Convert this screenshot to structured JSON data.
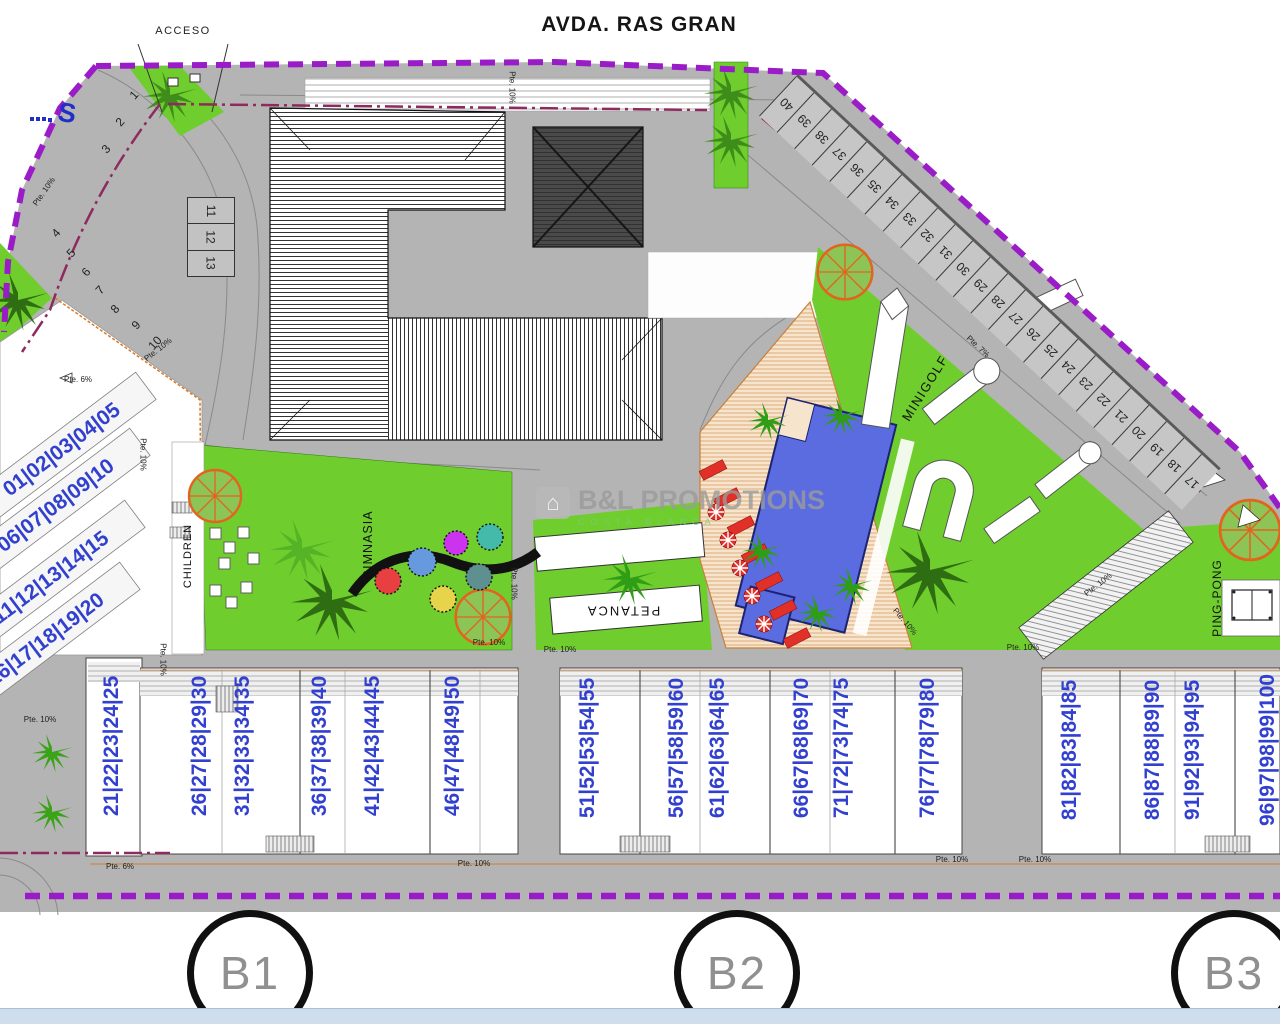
{
  "street_name": "AVDA. RAS GRAN",
  "access_label": "ACCESO",
  "corner_mark": "S",
  "icons": {
    "house": "⌂"
  },
  "watermark": {
    "brand": "B&L PROMOTIONS",
    "tagline": "COSTA BLANCA"
  },
  "zones": {
    "gym": "GIMNASIA",
    "petanca": "PETANCA",
    "minigolf": "MINIGOLF",
    "pingpong": "PING-PONG",
    "children": "CHILDREN"
  },
  "blocks": [
    {
      "id": "B1",
      "x": 250,
      "y": 973
    },
    {
      "id": "B2",
      "x": 737,
      "y": 973
    },
    {
      "id": "B3",
      "x": 1234,
      "y": 973
    }
  ],
  "parking": {
    "right_strip": [
      "40",
      "39",
      "38",
      "37",
      "36",
      "35",
      "34",
      "33",
      "32",
      "31",
      "30",
      "29",
      "28",
      "27",
      "26",
      "25",
      "24",
      "23",
      "22",
      "21",
      "20",
      "19",
      "18",
      "17"
    ],
    "left_upper": [
      {
        "n": "1",
        "x": 134,
        "y": 95,
        "rot": -48
      },
      {
        "n": "2",
        "x": 120,
        "y": 122,
        "rot": -48
      },
      {
        "n": "3",
        "x": 106,
        "y": 149,
        "rot": -48
      }
    ],
    "left_lower": [
      {
        "n": "4",
        "x": 56,
        "y": 233,
        "rot": -48
      },
      {
        "n": "5",
        "x": 71,
        "y": 253,
        "rot": -48
      },
      {
        "n": "6",
        "x": 86,
        "y": 272,
        "rot": -48
      },
      {
        "n": "7",
        "x": 100,
        "y": 290,
        "rot": -48
      },
      {
        "n": "8",
        "x": 115,
        "y": 309,
        "rot": -48
      },
      {
        "n": "9",
        "x": 136,
        "y": 325,
        "rot": -48
      },
      {
        "n": "10",
        "x": 155,
        "y": 343,
        "rot": -48
      }
    ],
    "left_block": [
      "11",
      "12",
      "13"
    ]
  },
  "units": {
    "left_groups": [
      {
        "label": "01|02|03|04|05",
        "x": 62,
        "y": 450,
        "rot": -37
      },
      {
        "label": "06|07|08|09|10",
        "x": 56,
        "y": 506,
        "rot": -37
      },
      {
        "label": "11|12|13|14|15",
        "x": 51,
        "y": 578,
        "rot": -37
      },
      {
        "label": "16|17|18|19|20",
        "x": 46,
        "y": 640,
        "rot": -37
      }
    ],
    "bottom_columns": [
      {
        "label": "21|22|23|24|25",
        "x": 112,
        "y": 746,
        "rot": -90
      },
      {
        "label": "26|27|28|29|30",
        "x": 200,
        "y": 746,
        "rot": -90
      },
      {
        "label": "31|32|33|34|35",
        "x": 243,
        "y": 746,
        "rot": -90
      },
      {
        "label": "36|37|38|39|40",
        "x": 320,
        "y": 746,
        "rot": -90
      },
      {
        "label": "41|42|43|44|45",
        "x": 373,
        "y": 746,
        "rot": -90
      },
      {
        "label": "46|47|48|49|50",
        "x": 453,
        "y": 746,
        "rot": -90
      },
      {
        "label": "51|52|53|54|55",
        "x": 588,
        "y": 748,
        "rot": -90
      },
      {
        "label": "56|57|58|59|60",
        "x": 677,
        "y": 748,
        "rot": -90
      },
      {
        "label": "61|62|63|64|65",
        "x": 718,
        "y": 748,
        "rot": -90
      },
      {
        "label": "66|67|68|69|70",
        "x": 802,
        "y": 748,
        "rot": -90
      },
      {
        "label": "71|72|73|74|75",
        "x": 842,
        "y": 748,
        "rot": -90
      },
      {
        "label": "76|77|78|79|80",
        "x": 928,
        "y": 748,
        "rot": -90
      },
      {
        "label": "81|82|83|84|85",
        "x": 1070,
        "y": 750,
        "rot": -90
      },
      {
        "label": "86|87|88|89|90",
        "x": 1153,
        "y": 750,
        "rot": -90
      },
      {
        "label": "91|92|93|94|95",
        "x": 1193,
        "y": 750,
        "rot": -90
      },
      {
        "label": "96|97|98|99|100",
        "x": 1268,
        "y": 750,
        "rot": -90
      }
    ]
  },
  "slope_labels": [
    {
      "text": "Pte. 10%",
      "x": 512,
      "y": 88,
      "rot": 90
    },
    {
      "text": "Pte. 7%",
      "x": 978,
      "y": 347,
      "rot": 43
    },
    {
      "text": "Pte. 6%",
      "x": 78,
      "y": 380,
      "rot": 0
    },
    {
      "text": "Pte. 10%",
      "x": 158,
      "y": 350,
      "rot": -38
    },
    {
      "text": "Pte. 10%",
      "x": 44,
      "y": 192,
      "rot": -55
    },
    {
      "text": "Pte. 10%",
      "x": 143,
      "y": 455,
      "rot": 90
    },
    {
      "text": "Pte. 10%",
      "x": 905,
      "y": 622,
      "rot": 50
    },
    {
      "text": "Pte. 10%",
      "x": 514,
      "y": 584,
      "rot": 90
    },
    {
      "text": "Pte. 10%",
      "x": 560,
      "y": 650,
      "rot": 0
    },
    {
      "text": "Pte. 10%",
      "x": 489,
      "y": 643,
      "rot": 0
    },
    {
      "text": "Pte. 6%",
      "x": 120,
      "y": 867,
      "rot": 0
    },
    {
      "text": "Pte. 10%",
      "x": 952,
      "y": 860,
      "rot": 0
    },
    {
      "text": "Pte. 10%",
      "x": 1035,
      "y": 860,
      "rot": 0
    },
    {
      "text": "Pte. 10%",
      "x": 474,
      "y": 864,
      "rot": 0
    },
    {
      "text": "Pte. 10%",
      "x": 40,
      "y": 720,
      "rot": 0
    },
    {
      "text": "Pte. 10%",
      "x": 163,
      "y": 660,
      "rot": 90
    },
    {
      "text": "Pte. 10%",
      "x": 1023,
      "y": 648,
      "rot": 0
    },
    {
      "text": "Pte. 10%",
      "x": 1098,
      "y": 585,
      "rot": -38
    }
  ],
  "colors": {
    "boundary": "#9a1cc8",
    "parcel": "#8e2a5e",
    "road": "#b4b4b4",
    "grass": "#6fce2e",
    "pool": "#5b6ce0",
    "deck": "#f6e4cc",
    "unit": "#3240d0",
    "lounger": "#e03028",
    "band": "#cfdeec",
    "orange": "#d97b28"
  }
}
